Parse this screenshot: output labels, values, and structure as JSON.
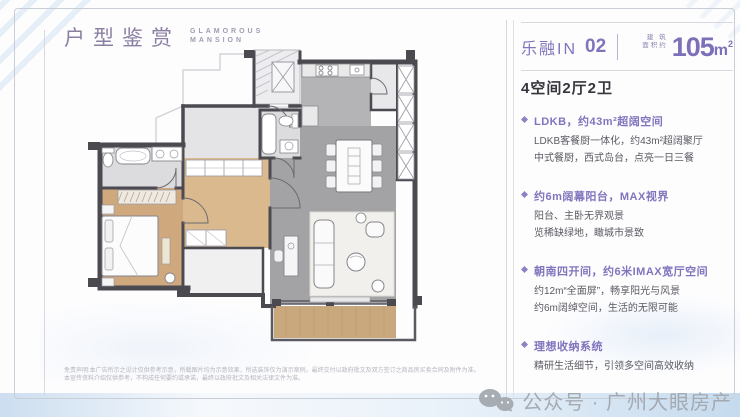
{
  "header": {
    "title_cn": "户型鉴赏",
    "title_en_line1": "GLAMOROUS",
    "title_en_line2": "MANSION"
  },
  "unit": {
    "name_cn": "乐融IN",
    "number": "02",
    "area_label_line1": "建 筑",
    "area_label_line2": "面积约",
    "area_value": "105",
    "area_unit": "m",
    "area_sup": "2",
    "layout": "4空间2厅2卫"
  },
  "features": [
    {
      "headline": "LDKB，约43m²超阔空间",
      "lines": [
        "LDKB客餐厨一体化，约43m²超阔聚厅",
        "中式餐厨，西式岛台，点亮一日三餐"
      ]
    },
    {
      "headline": "约6m阔幕阳台，MAX视界",
      "lines": [
        "阳台、主卧无界观景",
        "览稀缺绿地，瞰城市景致"
      ]
    },
    {
      "headline": "朝南四开间，约6米IMAX宽厅空间",
      "lines": [
        "约12m“全面屏”，畅享阳光与风景",
        "约6m阔绰空间，生活的无限可能"
      ]
    },
    {
      "headline": "理想收纳系统",
      "lines": [
        "精研生活细节，引领多空间高效收纳"
      ]
    }
  ],
  "disclaimer": {
    "line1": "免责声明:本广告所示之设计仅供参考示意，所载图片均为示意效果，所选装饰仅为演示案例，最终交付以政府批文及双方签订之商品房买卖合同及附件为准。",
    "line2": "本宣传资料介绍仅供参考，不构成任何要约或承诺，最终以政府批文及相关法律文件为准。"
  },
  "watermark": {
    "text": "公众号 · 广州大眼房产"
  },
  "colors": {
    "accent_purple": "#8174bd",
    "title_purple_gray": "#8b80a2",
    "dark_text": "#35353d",
    "body_text": "#5a5a62",
    "wall": "#4a4a50",
    "living_floor": "#a3a3a6",
    "wood_floor": "#cfa87e",
    "tile_floor": "#dcdcde",
    "watermark_gray": "#a0a5ad"
  }
}
